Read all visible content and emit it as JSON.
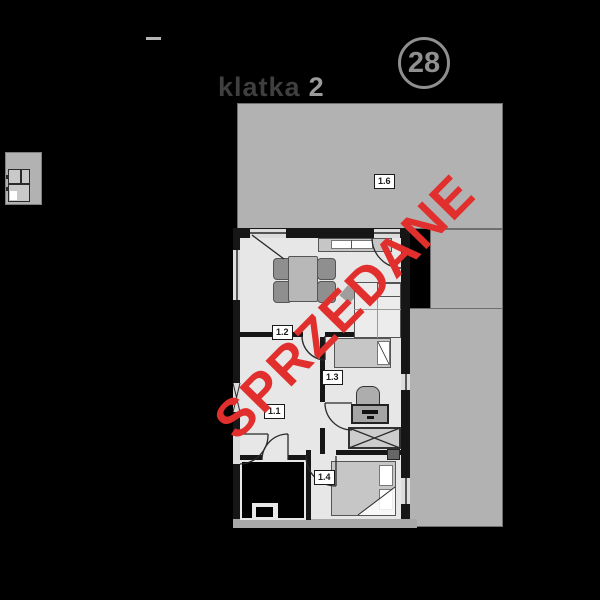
{
  "page": {
    "background": "#000000"
  },
  "header": {
    "staircase": {
      "word": "klatka",
      "number": "2"
    },
    "unit_badge": {
      "number": "28"
    }
  },
  "plan": {
    "rooms": [
      {
        "id": "1.1",
        "name": "hall"
      },
      {
        "id": "1.2",
        "name": "living-room-kitchen"
      },
      {
        "id": "1.3",
        "name": "bedroom"
      },
      {
        "id": "1.4",
        "name": "bedroom"
      },
      {
        "id": "1.6",
        "name": "terrace"
      }
    ],
    "sold": {
      "text": "SPRZEDANE",
      "color": "#e02f2d"
    },
    "colors": {
      "building_mass": "#b2b2b2",
      "apartment_floor": "#e7e7e7",
      "wall": "#161616",
      "bottom_wall": "#a8a8a8",
      "label_background": "#ffffff",
      "header_text_dark": "#3f3f3f",
      "header_text_light": "#9b9b9b",
      "badge_gray": "#8f8f8f"
    },
    "furniture_icons": [
      "kitchen-counter-icon",
      "sink-icon",
      "dining-table-icon",
      "chair-icon",
      "sofa-icon",
      "coffee-table-icon",
      "single-bed-icon",
      "desk-icon",
      "desk-chair-icon",
      "wardrobe-icon",
      "double-bed-icon",
      "nightstand-icon"
    ]
  },
  "thumbnail": {
    "name": "mini-floor-plan"
  }
}
